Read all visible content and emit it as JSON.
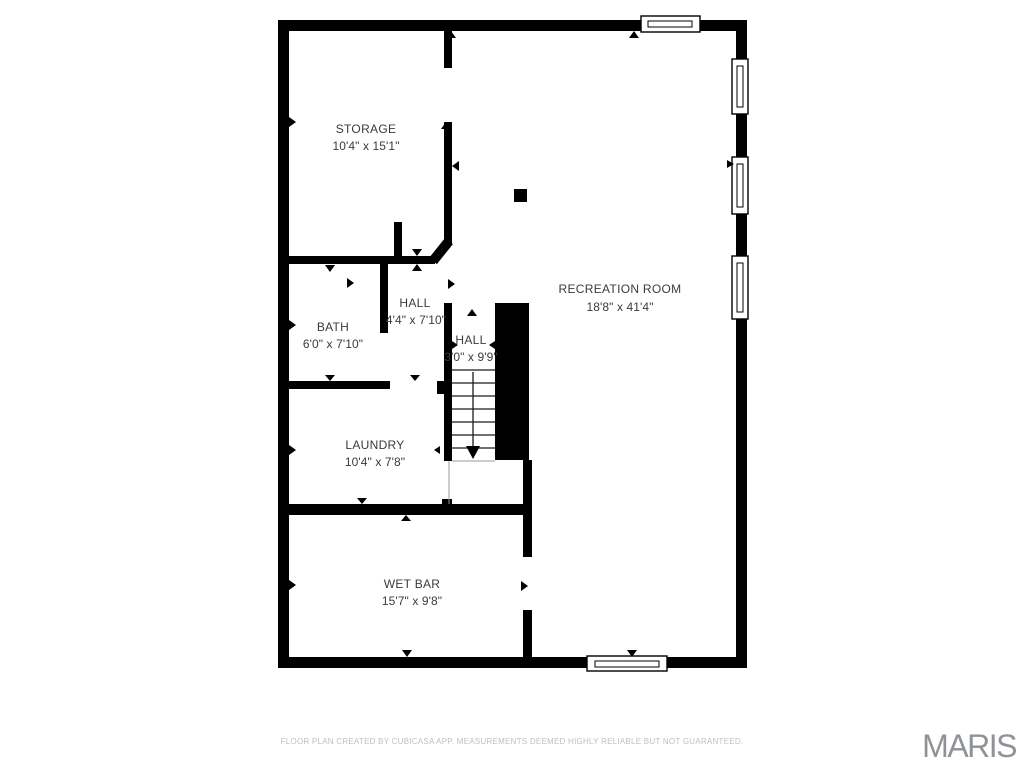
{
  "page": {
    "background": "#ffffff"
  },
  "colors": {
    "wall": "#000000",
    "room_text": "#3b3b3b",
    "disclaimer_text": "#bcbfc2",
    "logo_text": "#8f9396"
  },
  "rooms": [
    {
      "id": "storage",
      "name": "STORAGE",
      "dims": "10'4\" x 15'1\""
    },
    {
      "id": "recreation-room",
      "name": "RECREATION ROOM",
      "dims": "18'8\" x 41'4\""
    },
    {
      "id": "bath",
      "name": "BATH",
      "dims": "6'0\" x 7'10\""
    },
    {
      "id": "hall",
      "name": "HALL",
      "dims": "4'4\" x 7'10\""
    },
    {
      "id": "stair-hall",
      "name": "HALL",
      "dims": "3'0\" x 9'9\""
    },
    {
      "id": "laundry",
      "name": "LAUNDRY",
      "dims": "10'4\" x 7'8\""
    },
    {
      "id": "wet-bar",
      "name": "WET BAR",
      "dims": "15'7\" x 9'8\""
    }
  ],
  "footer": {
    "disclaimer": "FLOOR PLAN CREATED BY CUBICASA APP. MEASUREMENTS DEEMED HIGHLY RELIABLE BUT NOT GUARANTEED.",
    "logo": "MARIS"
  }
}
